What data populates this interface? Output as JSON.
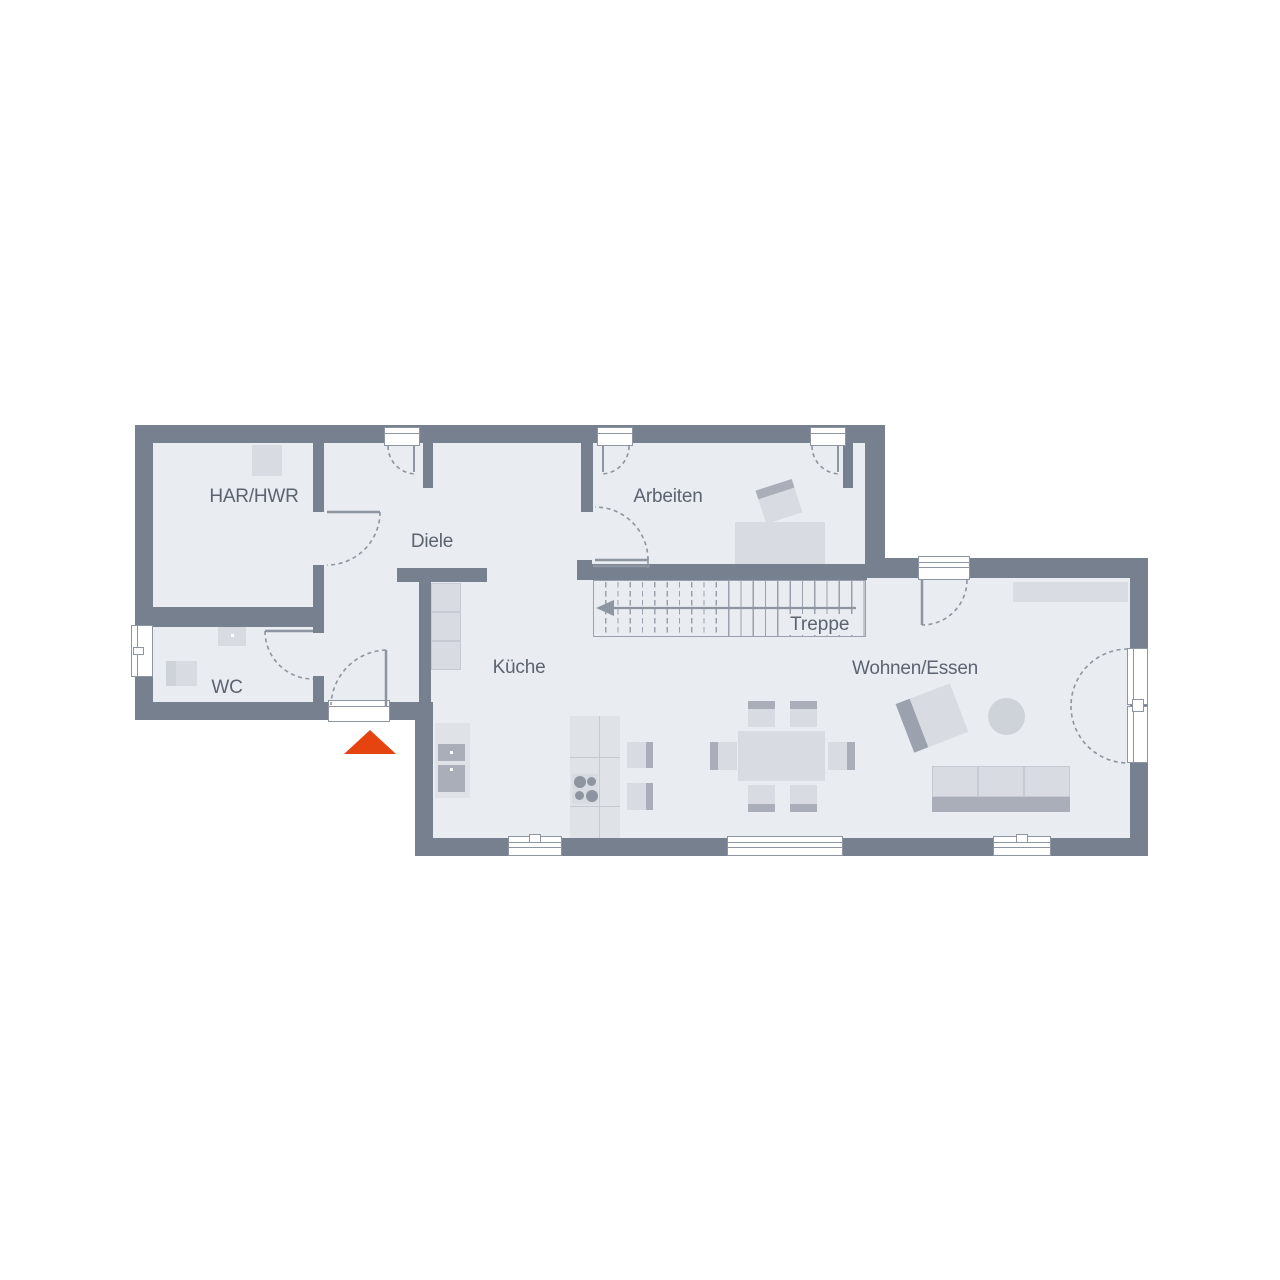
{
  "rooms": {
    "har": {
      "label": "HAR/HWR"
    },
    "diele": {
      "label": "Diele"
    },
    "wc": {
      "label": "WC"
    },
    "kueche": {
      "label": "Küche"
    },
    "arbeiten": {
      "label": "Arbeiten"
    },
    "treppe": {
      "label": "Treppe"
    },
    "wohnen": {
      "label": "Wohnen/Essen"
    }
  },
  "icons": {
    "entrance_marker": "entrance-triangle-icon"
  },
  "colors": {
    "wall": "#76808F",
    "floor": "#E9ECF1",
    "furniture": "#D8DBE2",
    "furniture_mid": "#CED3DA",
    "furniture_dark": "#A9AEB9",
    "line": "#8D95A1",
    "stair_line": "#9AA1AC",
    "text": "#5C6470",
    "accent": "#E5430F",
    "window": "#FFFFFF"
  }
}
